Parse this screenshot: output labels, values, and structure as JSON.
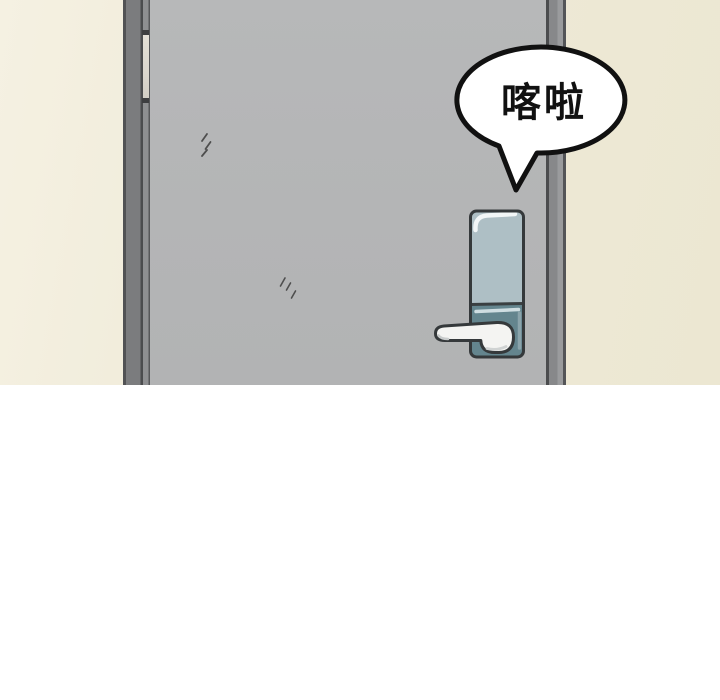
{
  "panel": {
    "speech_bubble": {
      "sfx_text": "喀啦"
    },
    "colors": {
      "page_background": "#ffffff",
      "wall_background": "#eee9d6",
      "door_face": "#b5b6b7",
      "door_frame": "#7b7c7e",
      "hinge": "#dbd7ce",
      "lock_plate_upper": "#aebfc5",
      "lock_plate_lower": "#64858e",
      "handle_fill": "#f4f4f2",
      "line_art_outline": "#35393b",
      "bubble_fill": "#ffffff",
      "bubble_outline": "#111111",
      "sfx_text_color": "#111111"
    }
  }
}
